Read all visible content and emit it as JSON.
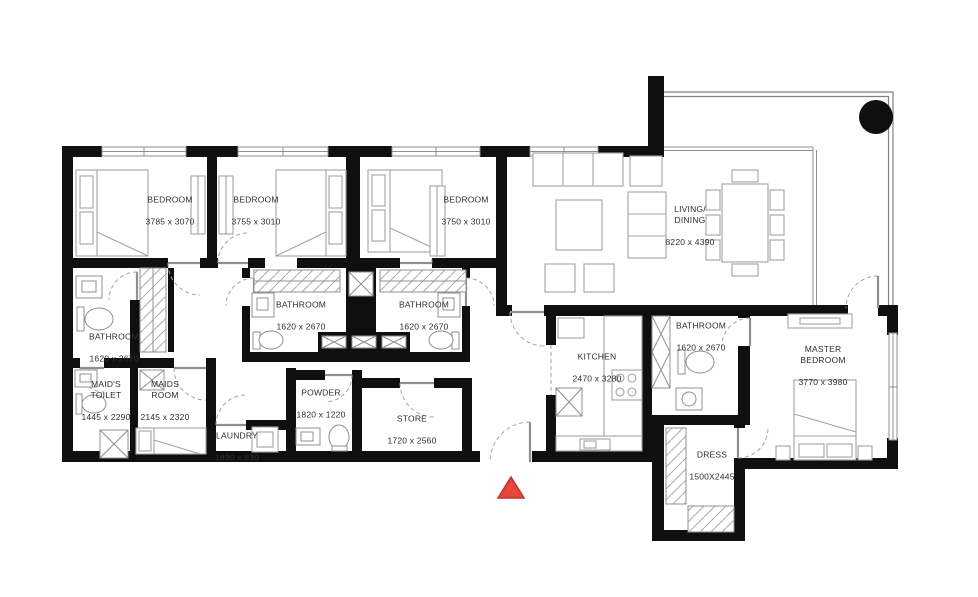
{
  "plan": {
    "colors": {
      "wall": "#0f0f0f",
      "furniture_line": "#9fa4a7",
      "window_line": "#8c9093",
      "entrance_marker": "#e8453c"
    },
    "rooms": [
      {
        "id": "bedroom-1",
        "name": "BEDROOM",
        "dims": "3785 x 3070"
      },
      {
        "id": "bedroom-2",
        "name": "BEDROOM",
        "dims": "3755 x 3010"
      },
      {
        "id": "bedroom-3",
        "name": "BEDROOM",
        "dims": "3750 x 3010"
      },
      {
        "id": "living-dining",
        "name": "LIVING/\nDINING",
        "dims": "8220 x 4390"
      },
      {
        "id": "bathroom-mid-left",
        "name": "BATHROOM",
        "dims": "1620 x 2670"
      },
      {
        "id": "bathroom-mid-right",
        "name": "BATHROOM",
        "dims": "1620 x 2670"
      },
      {
        "id": "bathroom-left",
        "name": "BATHROOM",
        "dims": "1620 x 2670"
      },
      {
        "id": "maids-toilet",
        "name": "MAID'S\nTOILET",
        "dims": "1445 x 2290"
      },
      {
        "id": "maids-room",
        "name": "MAIDS\nROOM",
        "dims": "2145 x 2320"
      },
      {
        "id": "laundry",
        "name": "LAUNDRY",
        "dims": "1830 x 830"
      },
      {
        "id": "powder",
        "name": "POWDER",
        "dims": "1820 x 1220"
      },
      {
        "id": "store",
        "name": "STORE",
        "dims": "1720 x 2560"
      },
      {
        "id": "kitchen",
        "name": "KITCHEN",
        "dims": "2470 x 3280"
      },
      {
        "id": "bathroom-master",
        "name": "BATHROOM",
        "dims": "1620 x 2670"
      },
      {
        "id": "dress",
        "name": "DRESS",
        "dims": "1500X2445"
      },
      {
        "id": "master-bedroom",
        "name": "MASTER\nBEDROOM",
        "dims": "3770 x 3980"
      }
    ]
  }
}
